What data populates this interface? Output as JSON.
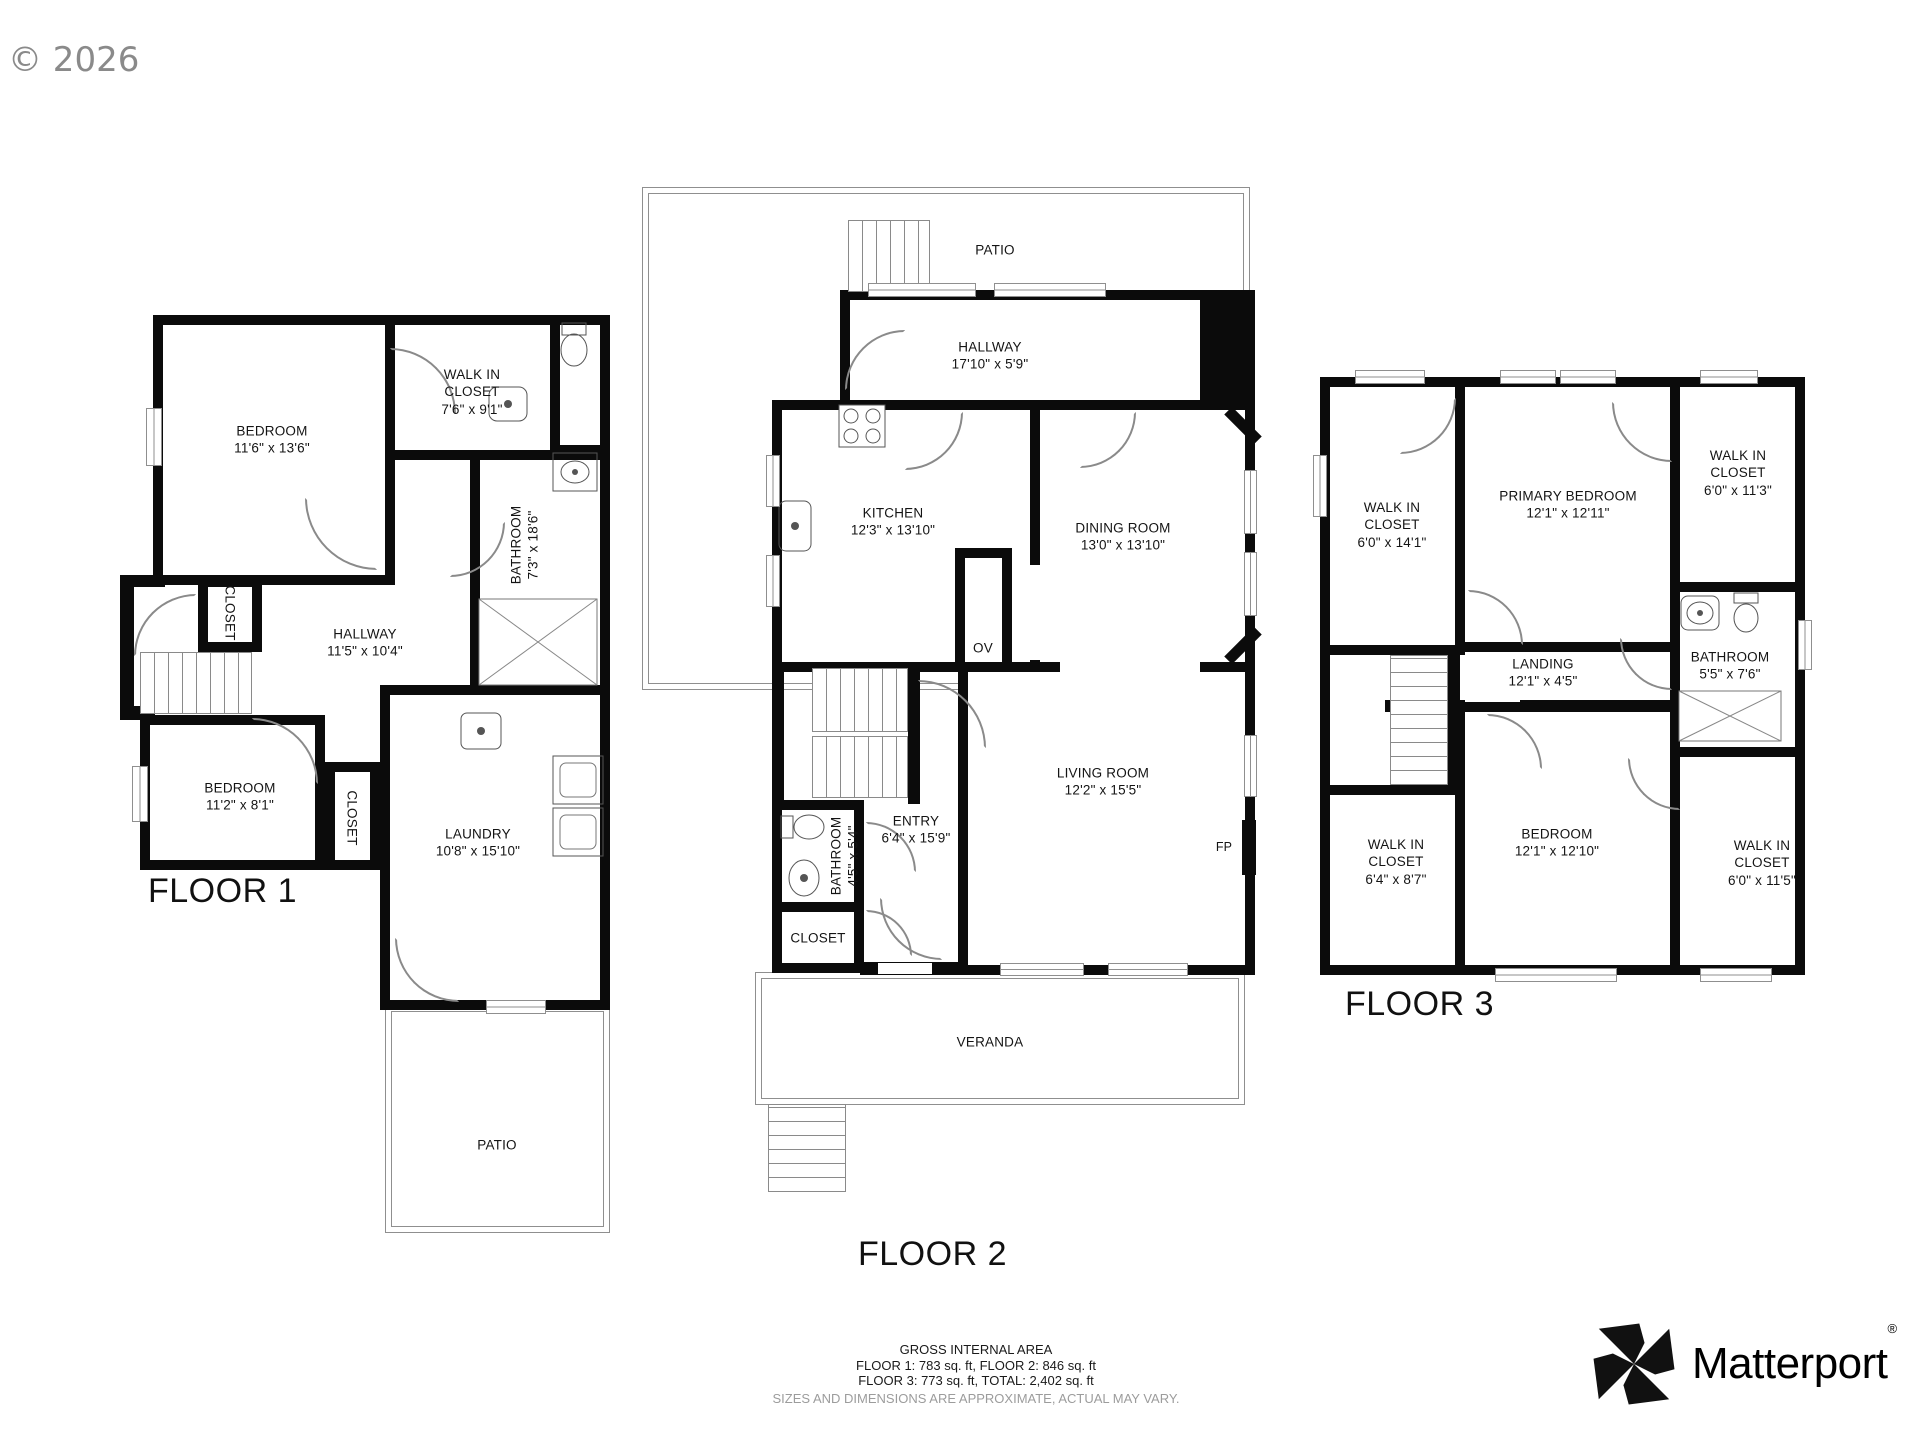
{
  "watermark": "© 2026",
  "footer": {
    "title": "GROSS INTERNAL AREA",
    "areas_line1": "FLOOR 1: 783 sq. ft, FLOOR 2: 846 sq. ft",
    "areas_line2": "FLOOR 3: 773 sq. ft, TOTAL: 2,402 sq. ft",
    "disclaimer": "SIZES AND DIMENSIONS ARE APPROXIMATE, ACTUAL MAY VARY."
  },
  "brand": {
    "name": "Matterport",
    "registered": "®"
  },
  "floor1": {
    "label": "FLOOR 1",
    "bedroom1": {
      "name": "BEDROOM",
      "dims": "11'6\" x 13'6\""
    },
    "walkin_closet": {
      "name": "WALK IN CLOSET",
      "dims": "7'6\" x 9'1\""
    },
    "bathroom": {
      "name": "BATHROOM",
      "dims": "7'3\" x 18'6\""
    },
    "closet_upper": {
      "name": "CLOSET"
    },
    "hallway": {
      "name": "HALLWAY",
      "dims": "11'5\" x 10'4\""
    },
    "bedroom2": {
      "name": "BEDROOM",
      "dims": "11'2\" x 8'1\""
    },
    "closet_lower": {
      "name": "CLOSET"
    },
    "laundry": {
      "name": "LAUNDRY",
      "dims": "10'8\" x 15'10\""
    },
    "patio": {
      "name": "PATIO"
    }
  },
  "floor2": {
    "label": "FLOOR 2",
    "patio": {
      "name": "PATIO"
    },
    "hallway": {
      "name": "HALLWAY",
      "dims": "17'10\" x 5'9\""
    },
    "kitchen": {
      "name": "KITCHEN",
      "dims": "12'3\" x 13'10\""
    },
    "dining": {
      "name": "DINING ROOM",
      "dims": "13'0\" x 13'10\""
    },
    "oven": {
      "name": "OV"
    },
    "living": {
      "name": "LIVING ROOM",
      "dims": "12'2\" x 15'5\""
    },
    "entry": {
      "name": "ENTRY",
      "dims": "6'4\" x 15'9\""
    },
    "bathroom": {
      "name": "BATHROOM",
      "dims": "4'5\" x 5'4\""
    },
    "closet": {
      "name": "CLOSET"
    },
    "fireplace": {
      "name": "FP"
    },
    "veranda": {
      "name": "VERANDA"
    }
  },
  "floor3": {
    "label": "FLOOR 3",
    "walkin_left": {
      "name": "WALK IN CLOSET",
      "dims": "6'0\" x 14'1\""
    },
    "primary_bedroom": {
      "name": "PRIMARY BEDROOM",
      "dims": "12'1\" x 12'11\""
    },
    "walkin_top_right": {
      "name": "WALK IN CLOSET",
      "dims": "6'0\" x 11'3\""
    },
    "landing": {
      "name": "LANDING",
      "dims": "12'1\" x 4'5\""
    },
    "bathroom": {
      "name": "BATHROOM",
      "dims": "5'5\" x 7'6\""
    },
    "walkin_bottom_left": {
      "name": "WALK IN CLOSET",
      "dims": "6'4\" x 8'7\""
    },
    "bedroom": {
      "name": "BEDROOM",
      "dims": "12'1\" x 12'10\""
    },
    "walkin_bottom_right": {
      "name": "WALK IN CLOSET",
      "dims": "6'0\" x 11'5\""
    }
  }
}
